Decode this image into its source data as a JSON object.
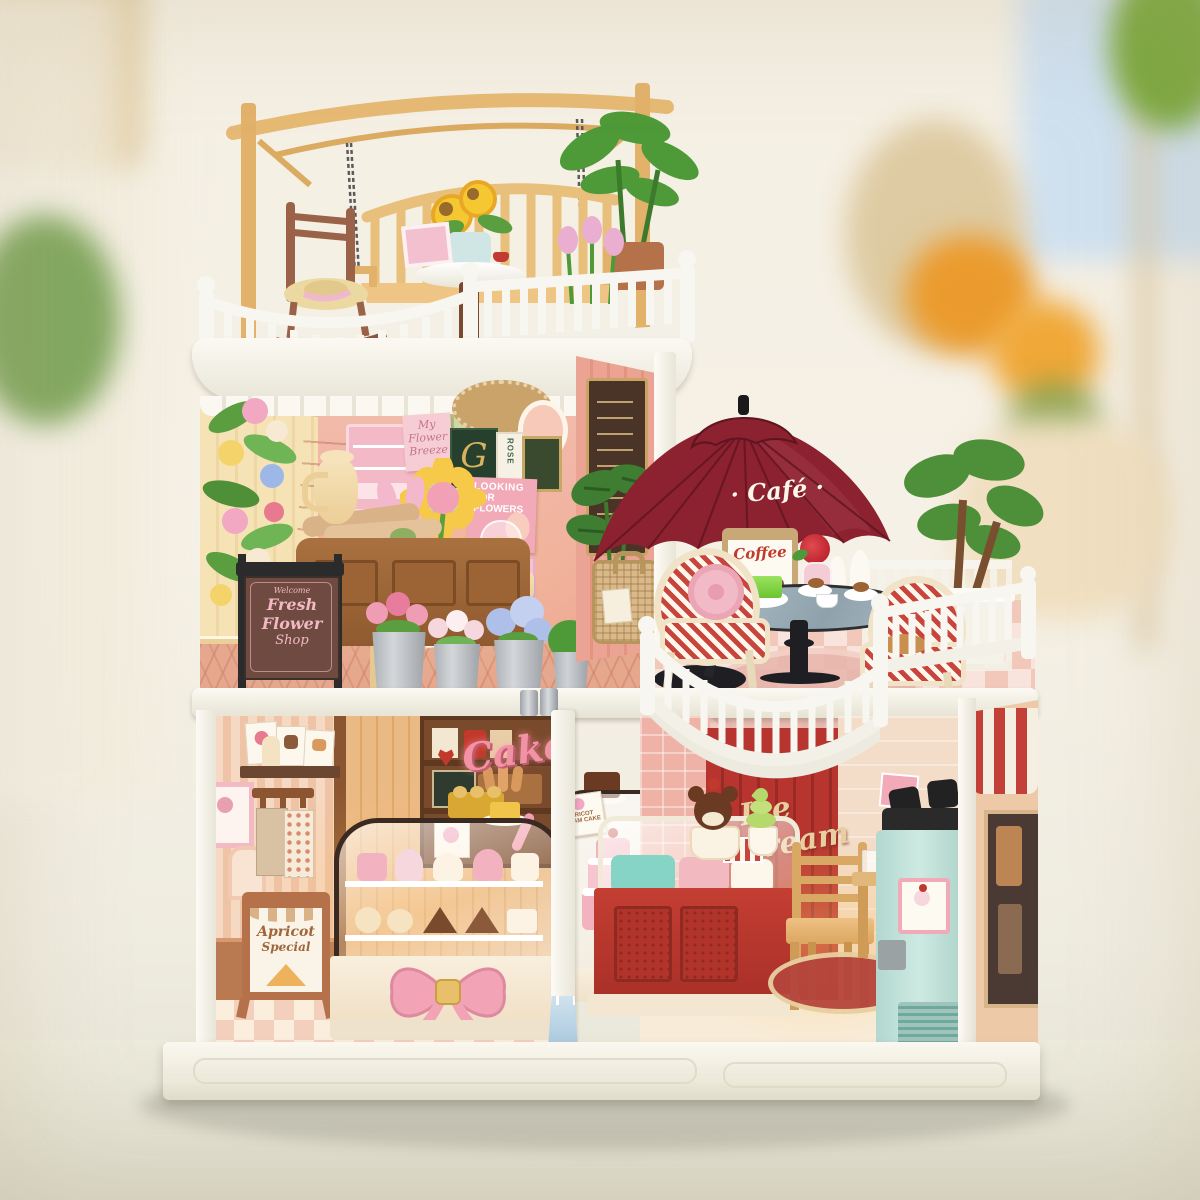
{
  "signs": {
    "umbrella_label": "· Café ·",
    "coffee_board": "Coffee",
    "chalkboard": {
      "welcome": "Welcome",
      "line1": "Fresh",
      "line2": "Flower",
      "line3": "Shop"
    },
    "cake_neon": "Cake",
    "ice_cream_script": "Ice cream",
    "apricot_easel": {
      "line1": "Apricot",
      "line2": "Special"
    },
    "apricot_card": {
      "line1": "APRICOT",
      "line2": "CREAM CAKE"
    },
    "looking_poster": {
      "line1": "LOOKING",
      "line2": "FOR",
      "line3": "FLOWERS"
    },
    "breeze_poster": {
      "line1": "My",
      "line2": "Flower",
      "line3": "Breeze"
    },
    "book_g": "G",
    "book_rose": "ROSE"
  },
  "colors": {
    "umbrella_red": "#8c2130",
    "cake_pink": "#f193a5",
    "counter_red": "#bf3a30",
    "machine_mint": "#c3e4dc",
    "wall_pink": "#f0b1a0",
    "wall_cream": "#f5e3b6",
    "wood_tan": "#e9b783",
    "railing_white": "#f8f6f0"
  }
}
